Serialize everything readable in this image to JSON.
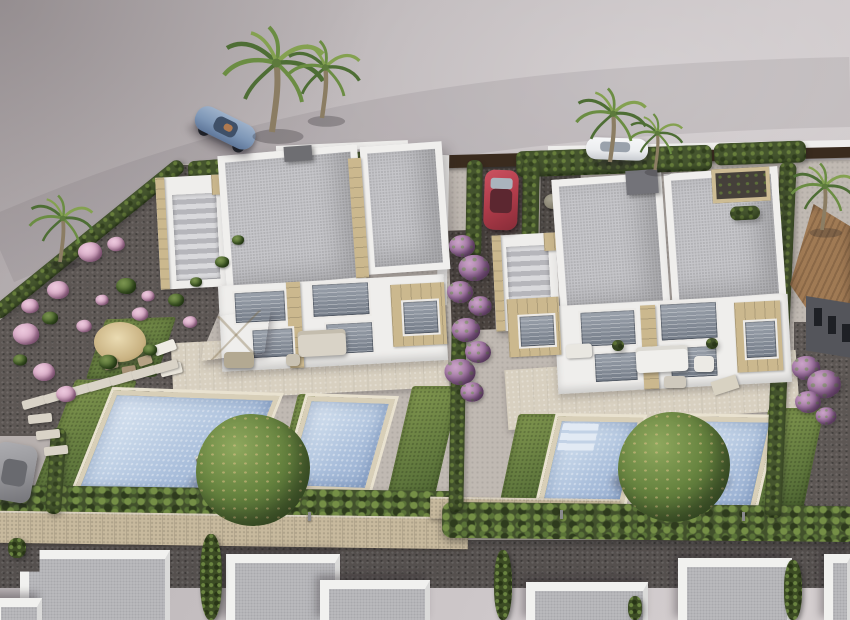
{
  "scene": {
    "type": "aerial-3d-architectural-render",
    "description": "Aerial 3D render of two modern white duplex villas with flat gray roofs, private mosaic pools, lawns, cypress hedges, palm trees, a straw parasol garden, parked cars (blue convertible, red hatchback, white sedan, gray car) and a row of neighbouring white roofs along the bottom."
  },
  "palette": {
    "land-1": "#aba4a6",
    "land-2": "#c2bcbe",
    "land-3": "#cfc9cb",
    "gravel": "#5d5754",
    "paving": "#c0b9b2",
    "lawn-1": "#81974f",
    "lawn-2": "#5e763c",
    "lawn-3": "#49602f",
    "hedge-1": "#45552e",
    "hedge-2": "#687f3c",
    "pool-1": "#c5d5e8",
    "pool-2": "#a9bedb",
    "coping": "#d8cfb8",
    "terrace": "#d8d0c0",
    "roof-1": "#c6c6ca",
    "roof-edge": "#f0efed",
    "white-wall": "#efeeec",
    "stone": "#cbb88e",
    "fence": "#3a2b1e",
    "wall-stone": "#c7b99d",
    "path-dark": "#55504e",
    "car-blue": "#7e97b7",
    "car-red": "#b03c4a",
    "car-white": "#eceef0",
    "car-gray": "#96969a",
    "purple-1": "#a276a4",
    "pink-1": "#d9abc7",
    "trunk": "#8b7d63",
    "frond-1": "#4e6e35",
    "frond-2": "#6b8d43",
    "frond-3": "#84a150",
    "tile-roof": "#96714e",
    "dark-wall": "#54555b",
    "tree-1": "#66833f"
  },
  "palms": [
    {
      "x": 60,
      "y": 262,
      "s": "0.95"
    },
    {
      "x": 272,
      "y": 132,
      "s": "1.5"
    },
    {
      "x": 322,
      "y": 118,
      "s": "1.1"
    },
    {
      "x": 610,
      "y": 162,
      "s": "1.05"
    },
    {
      "x": 655,
      "y": 170,
      "s": "0.8"
    },
    {
      "x": 822,
      "y": 230,
      "s": "0.95"
    }
  ],
  "pink_bushes": [
    {
      "x": 90,
      "y": 252,
      "s": "1.1"
    },
    {
      "x": 116,
      "y": 244,
      "s": "0.8"
    },
    {
      "x": 58,
      "y": 290,
      "s": "1.0"
    },
    {
      "x": 26,
      "y": 334,
      "s": "1.2"
    },
    {
      "x": 44,
      "y": 372,
      "s": "1.0"
    },
    {
      "x": 84,
      "y": 326,
      "s": "0.7"
    },
    {
      "x": 140,
      "y": 314,
      "s": "0.75"
    },
    {
      "x": 66,
      "y": 394,
      "s": "0.9"
    },
    {
      "x": 148,
      "y": 296,
      "s": "0.6"
    },
    {
      "x": 190,
      "y": 322,
      "s": "0.65"
    },
    {
      "x": 102,
      "y": 300,
      "s": "0.6"
    },
    {
      "x": 30,
      "y": 306,
      "s": "0.8"
    }
  ],
  "green_shrubs": [
    {
      "x": 126,
      "y": 286,
      "s": "1"
    },
    {
      "x": 50,
      "y": 318,
      "s": "0.8"
    },
    {
      "x": 108,
      "y": 362,
      "s": "0.9"
    },
    {
      "x": 176,
      "y": 300,
      "s": "0.8"
    },
    {
      "x": 222,
      "y": 262,
      "s": "0.7"
    },
    {
      "x": 238,
      "y": 240,
      "s": "0.6"
    },
    {
      "x": 196,
      "y": 282,
      "s": "0.6"
    },
    {
      "x": 150,
      "y": 350,
      "s": "0.7"
    },
    {
      "x": 20,
      "y": 360,
      "s": "0.7"
    }
  ],
  "purple_puffs": [
    {
      "x": 462,
      "y": 246,
      "s": "1.0"
    },
    {
      "x": 474,
      "y": 268,
      "s": "1.2"
    },
    {
      "x": 460,
      "y": 292,
      "s": "1.0"
    },
    {
      "x": 480,
      "y": 306,
      "s": "0.9"
    },
    {
      "x": 466,
      "y": 330,
      "s": "1.1"
    },
    {
      "x": 478,
      "y": 352,
      "s": "1.0"
    },
    {
      "x": 460,
      "y": 372,
      "s": "1.2"
    },
    {
      "x": 472,
      "y": 392,
      "s": "0.9"
    },
    {
      "x": 806,
      "y": 368,
      "s": "1.1"
    },
    {
      "x": 824,
      "y": 384,
      "s": "1.3"
    },
    {
      "x": 808,
      "y": 402,
      "s": "1.0"
    },
    {
      "x": 826,
      "y": 416,
      "s": "0.8"
    }
  ],
  "stepping_stones": [
    {
      "x": 22,
      "y": 398,
      "r": "-16deg"
    },
    {
      "x": 44,
      "y": 392,
      "r": "-16deg"
    },
    {
      "x": 66,
      "y": 386,
      "r": "-16deg"
    },
    {
      "x": 88,
      "y": 380,
      "r": "-16deg"
    },
    {
      "x": 110,
      "y": 374,
      "r": "-16deg"
    },
    {
      "x": 132,
      "y": 368,
      "r": "-16deg"
    },
    {
      "x": 154,
      "y": 362,
      "r": "-16deg"
    },
    {
      "x": 28,
      "y": 414,
      "r": "-6deg"
    },
    {
      "x": 36,
      "y": 430,
      "r": "-6deg"
    },
    {
      "x": 44,
      "y": 446,
      "r": "-6deg"
    }
  ],
  "cypress_bushes": [
    {
      "x": 200,
      "y": 534,
      "w": 22,
      "h": 86
    },
    {
      "x": 494,
      "y": 550,
      "w": 18,
      "h": 70
    },
    {
      "x": 784,
      "y": 560,
      "w": 18,
      "h": 60
    },
    {
      "x": 8,
      "y": 538,
      "w": 18,
      "h": 20
    },
    {
      "x": 628,
      "y": 596,
      "w": 14,
      "h": 24
    }
  ],
  "bottom_buildings": [
    {
      "x": 20,
      "y": 550,
      "w": 150,
      "h": 72,
      "clip": "polygon(0 30%, 13% 30%, 13% 0, 100% 0, 100% 100%, 0 100%)"
    },
    {
      "x": 226,
      "y": 554,
      "w": 114,
      "h": 68
    },
    {
      "x": 320,
      "y": 580,
      "w": 110,
      "h": 42
    },
    {
      "x": -8,
      "y": 598,
      "w": 50,
      "h": 24
    },
    {
      "x": 526,
      "y": 582,
      "w": 122,
      "h": 40
    },
    {
      "x": 678,
      "y": 558,
      "w": 114,
      "h": 64
    },
    {
      "x": 824,
      "y": 554,
      "w": 28,
      "h": 68
    }
  ]
}
